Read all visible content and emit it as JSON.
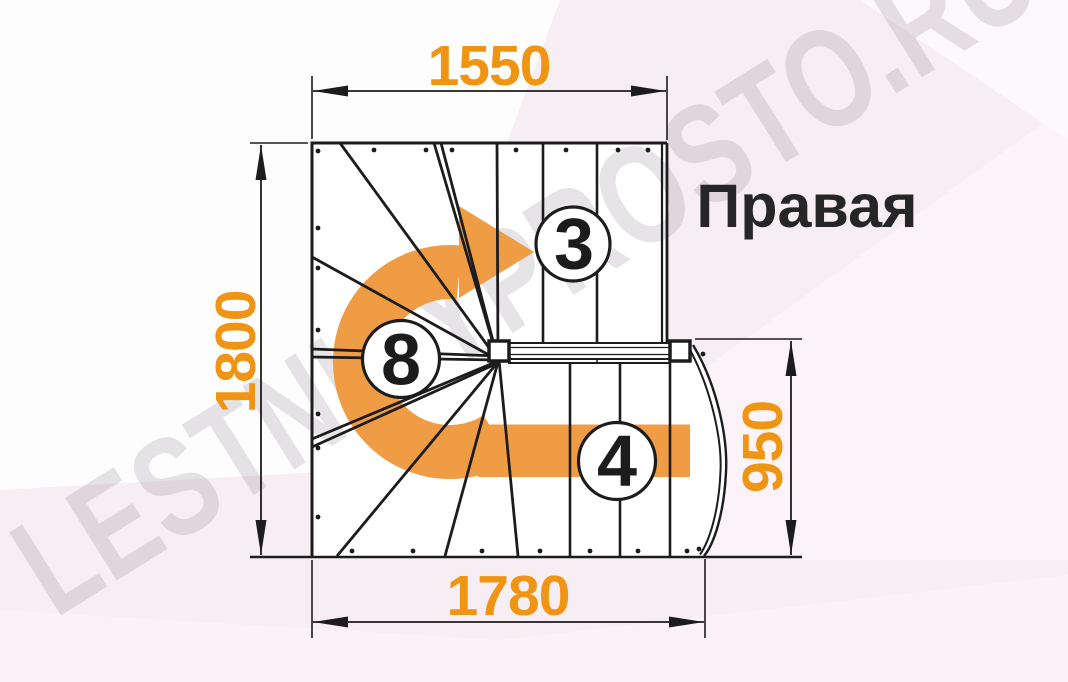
{
  "title": "Правая",
  "watermark": "LESTNICYPROSTO.RU",
  "dimensions": {
    "top": "1550",
    "left": "1800",
    "right": "950",
    "bottom": "1780"
  },
  "step_markers": [
    {
      "id": "upper-flight-step",
      "label": "3"
    },
    {
      "id": "winder-step",
      "label": "8"
    },
    {
      "id": "lower-flight-step",
      "label": "4"
    }
  ],
  "colors": {
    "dimension_text": "#ef9413",
    "arrow": "#f09c44",
    "line": "#1c1c1c",
    "background": "#f7eef3"
  }
}
